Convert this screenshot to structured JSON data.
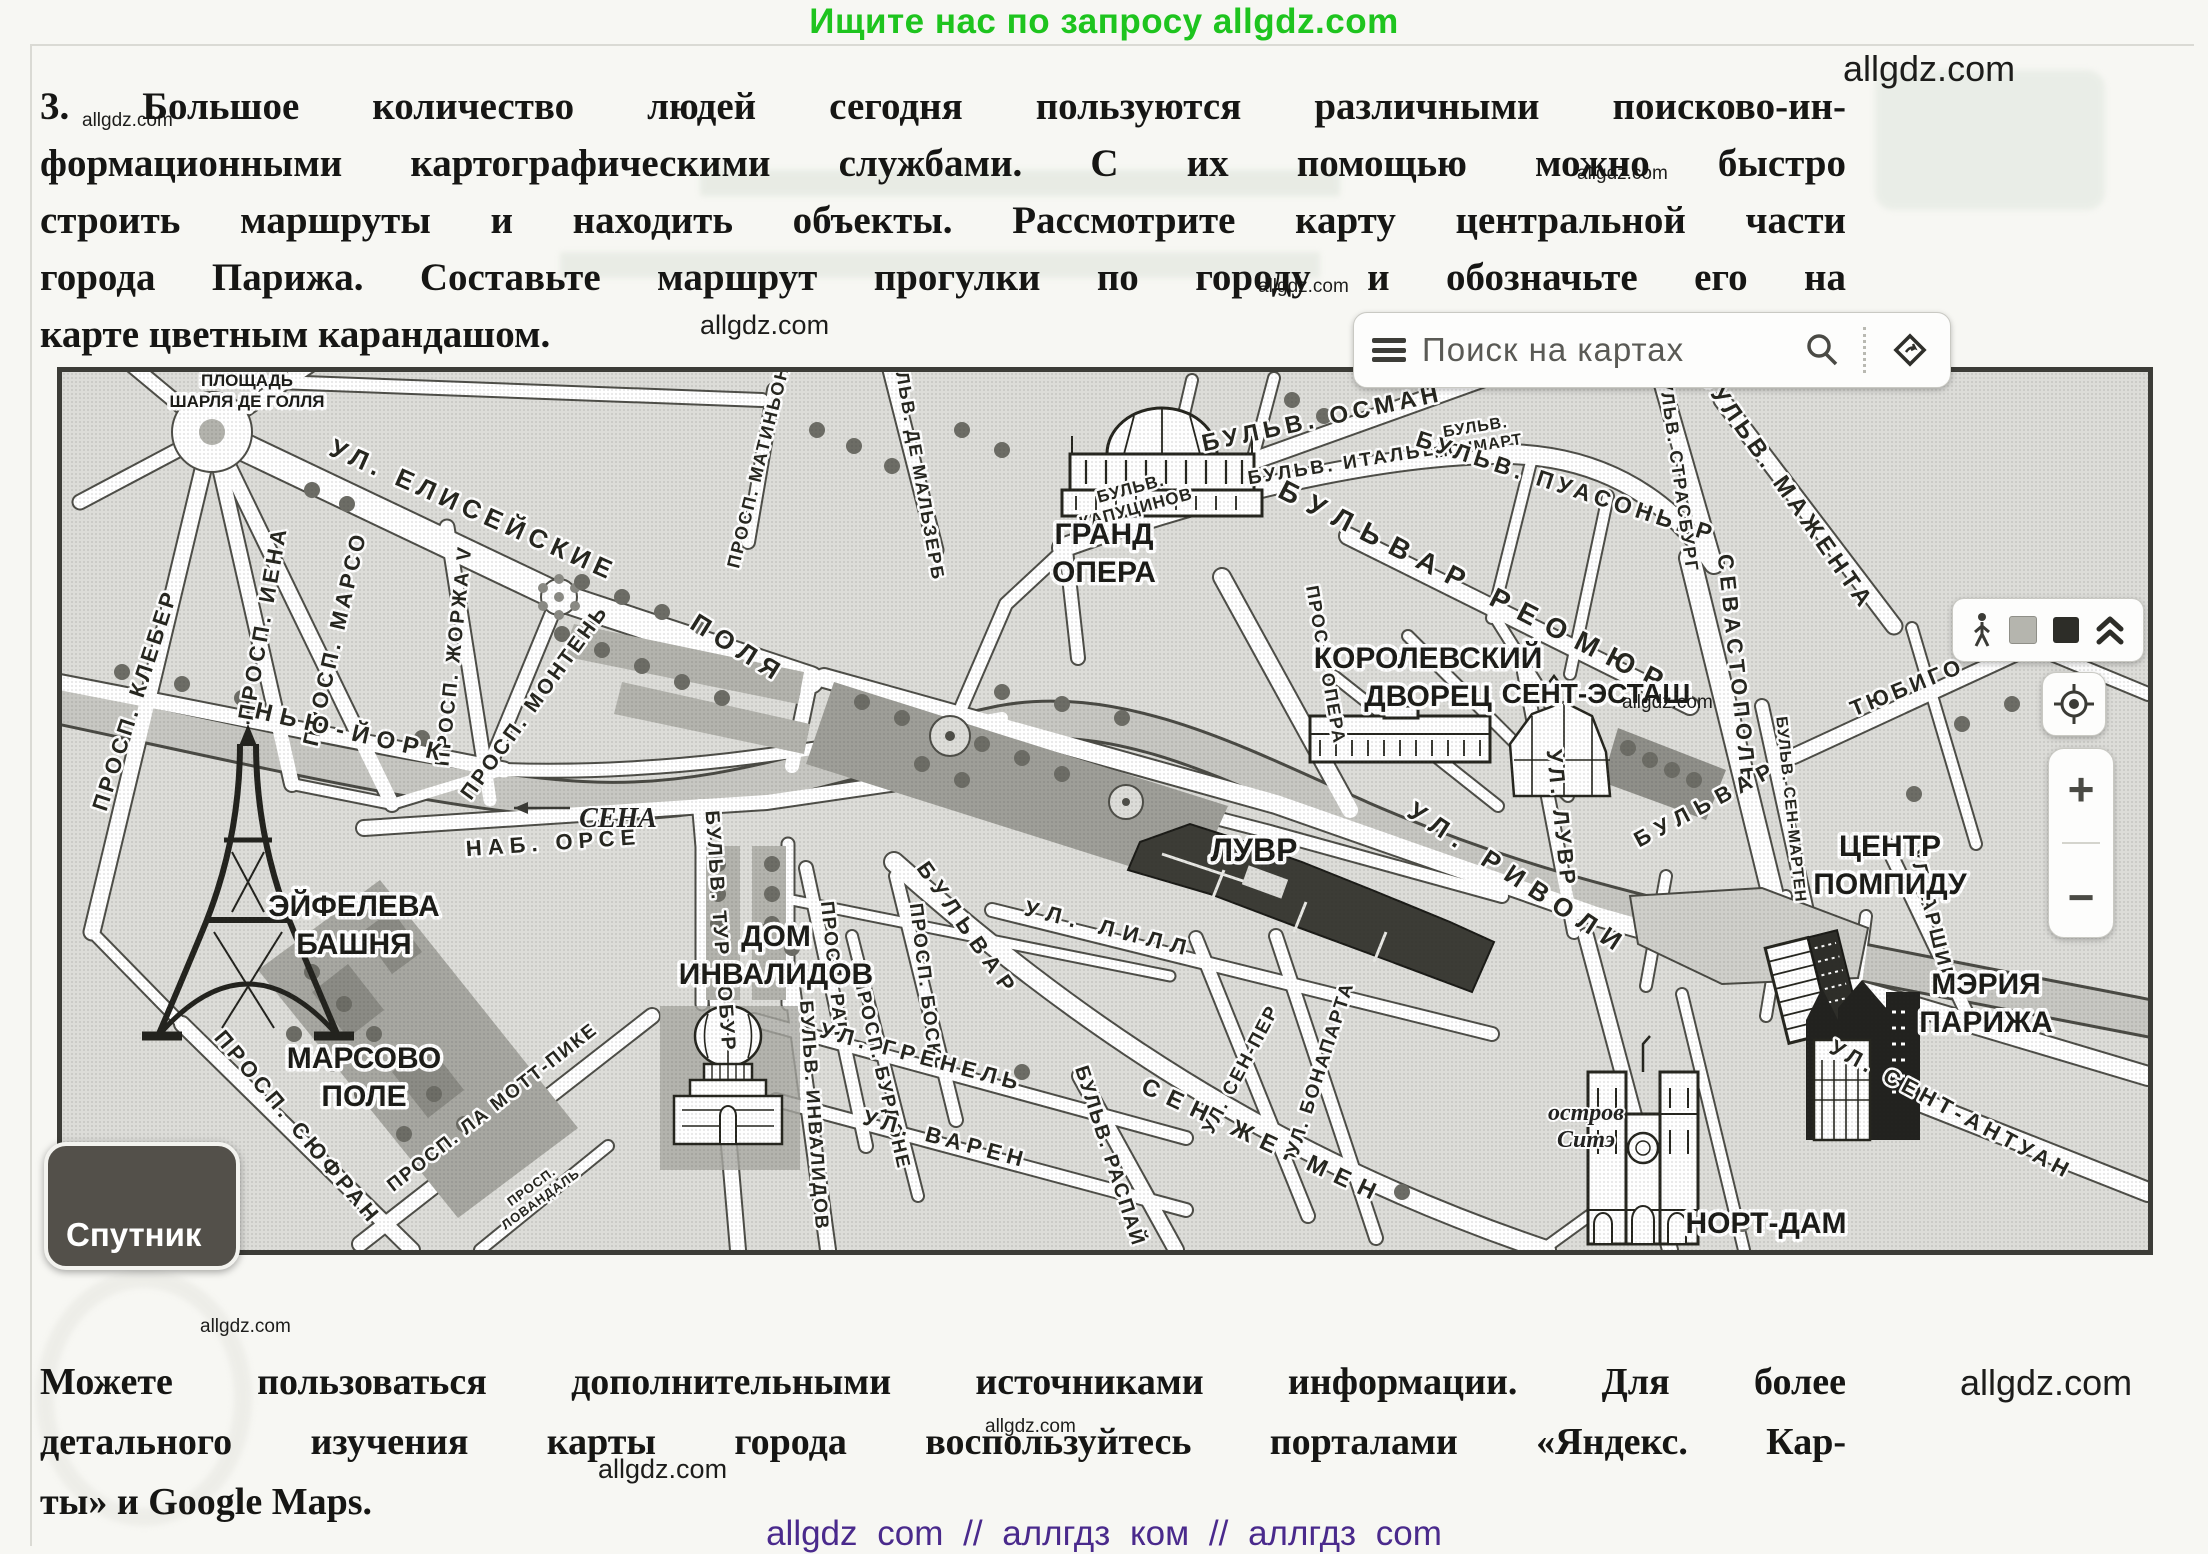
{
  "header": {
    "promo": "Ищите нас по запросу allgdz.com"
  },
  "watermark": {
    "text": "allgdz.com"
  },
  "task": {
    "lines": [
      "3. Большое количество людей сегодня пользуются различными поисково-ин-",
      "формационными картографическими службами. С их помощью можно быстро",
      "строить маршруты и находить объекты. Рассмотрите карту центральной части",
      "города Парижа. Составьте маршрут прогулки по городу и обозначьте его на",
      "карте цветным карандашом."
    ]
  },
  "map": {
    "search": {
      "placeholder": "Поиск на картах"
    },
    "satellite_label": "Спутник",
    "zoom_in_label": "+",
    "zoom_out_label": "−",
    "icons": [
      "hamburger-menu",
      "magnifier",
      "route-diamond",
      "pedestrian",
      "layer-light-square",
      "layer-dark-square",
      "double-chevron-up",
      "compass-target"
    ],
    "watermark": "allgdz.com",
    "landmarks": [
      {
        "lines": [
          "ПЛОЩАДЬ",
          "ШАРЛЯ ДЕ ГОЛЛЯ"
        ],
        "x": 185,
        "y": 14,
        "s": 17,
        "lh": 21
      },
      {
        "lines": [
          "ГРАНД",
          "ОПЕРА"
        ],
        "x": 1042,
        "y": 172,
        "s": 30,
        "lh": 38
      },
      {
        "lines": [
          "КОРОЛЕВСКИЙ",
          "ДВОРЕЦ"
        ],
        "x": 1366,
        "y": 296,
        "s": 30,
        "lh": 38
      },
      {
        "lines": [
          "СЕНТ-ЭСТАШ"
        ],
        "x": 1534,
        "y": 314,
        "s": 28,
        "lh": 34
      },
      {
        "lines": [
          "ЦЕНТР",
          "ПОМПИДУ"
        ],
        "x": 1828,
        "y": 484,
        "s": 30,
        "lh": 38
      },
      {
        "lines": [
          "МЭРИЯ",
          "ПАРИЖА"
        ],
        "x": 1924,
        "y": 622,
        "s": 30,
        "lh": 38
      },
      {
        "lines": [
          "НОРТ-ДАМ"
        ],
        "x": 1704,
        "y": 844,
        "s": 30,
        "lh": 34
      },
      {
        "lines": [
          "ЛУВР"
        ],
        "x": 1192,
        "y": 472,
        "s": 32,
        "lh": 34
      },
      {
        "lines": [
          "ЭЙФЕЛЕВА",
          "БАШНЯ"
        ],
        "x": 292,
        "y": 544,
        "s": 30,
        "lh": 38
      },
      {
        "lines": [
          "ДОМ",
          "ИНВАЛИДОВ"
        ],
        "x": 714,
        "y": 574,
        "s": 30,
        "lh": 38
      },
      {
        "lines": [
          "МАРСОВО",
          "ПОЛЕ"
        ],
        "x": 302,
        "y": 696,
        "s": 30,
        "lh": 38
      },
      {
        "lines": [
          "СЕНА"
        ],
        "x": 556,
        "y": 440,
        "s": 28,
        "lh": 30,
        "cls": "river"
      },
      {
        "lines": [
          "остров",
          "Ситэ"
        ],
        "x": 1524,
        "y": 748,
        "s": 24,
        "lh": 27,
        "cls": "island"
      }
    ],
    "street_labels": [
      {
        "t": "УЛ.  ЕЛИСЕЙСКИЕ",
        "x": 408,
        "y": 146,
        "r": 24,
        "s": 26,
        "ls": 6
      },
      {
        "t": "ПОЛЯ",
        "x": 672,
        "y": 284,
        "r": 32,
        "s": 26,
        "ls": 8
      },
      {
        "t": "ПРОСП.  КЛЕБЕР",
        "x": 80,
        "y": 330,
        "r": -72,
        "s": 22,
        "ls": 4
      },
      {
        "t": "ПРОСП.  ИЕНА",
        "x": 208,
        "y": 252,
        "r": -80,
        "s": 22,
        "ls": 4
      },
      {
        "t": "ПРОСП.  МАРСО",
        "x": 280,
        "y": 268,
        "r": -77,
        "s": 22,
        "ls": 4
      },
      {
        "t": "ПРОСП. ЖОРЖА V",
        "x": 398,
        "y": 284,
        "r": -84,
        "s": 20,
        "ls": 3
      },
      {
        "t": "ПРОСП. МОНТЕНЬ",
        "x": 478,
        "y": 334,
        "r": -54,
        "s": 21,
        "ls": 3
      },
      {
        "t": "ПРОСП. МАТИНЬОН",
        "x": 702,
        "y": 96,
        "r": -76,
        "s": 18,
        "ls": 2
      },
      {
        "t": "БУЛЬВ. ДЕ МАЛЬЗЕРБ",
        "x": 850,
        "y": 92,
        "r": 80,
        "s": 18,
        "ls": 2
      },
      {
        "t": "БУЛЬВ. ОСМАН",
        "x": 1262,
        "y": 54,
        "r": -12,
        "s": 24,
        "ls": 5
      },
      {
        "t": "БУЛЬВ. ИТАЛЬЕН",
        "x": 1290,
        "y": 96,
        "r": -9,
        "s": 19,
        "ls": 3
      },
      {
        "lines": [
          "БУЛЬВ.",
          "МОНМАРТ"
        ],
        "x": 1414,
        "y": 60,
        "r": -9,
        "s": 16,
        "ls": 1
      },
      {
        "t": "БУЛЬВ. ПУАСОНЬЕР",
        "x": 1502,
        "y": 122,
        "r": 18,
        "s": 23,
        "ls": 5
      },
      {
        "t": "БУЛЬВ. СТРАСБУРГ",
        "x": 1610,
        "y": 98,
        "r": 82,
        "s": 18,
        "ls": 2
      },
      {
        "t": "БУЛЬВ. МАЖЕНТА",
        "x": 1718,
        "y": 122,
        "r": 55,
        "s": 24,
        "ls": 5
      },
      {
        "t": "БУЛЬВАР  РЕОМЮР",
        "x": 1410,
        "y": 224,
        "r": 27,
        "s": 28,
        "ls": 12
      },
      {
        "lines": [
          "БУЛЬВ.",
          "КАПУЦИНОВ"
        ],
        "x": 1070,
        "y": 122,
        "r": -15,
        "s": 17,
        "ls": 1
      },
      {
        "t": "ПРОСП. ОПЕРА",
        "x": 1258,
        "y": 294,
        "r": 80,
        "s": 18,
        "ls": 2
      },
      {
        "t": "СЕВАСТОПОЛЬ",
        "x": 1668,
        "y": 300,
        "r": 84,
        "s": 22,
        "ls": 6
      },
      {
        "t": "БУЛЬВАР",
        "x": 1648,
        "y": 438,
        "r": -28,
        "s": 22,
        "ls": 8
      },
      {
        "t": "БУЛЬВ. СЕН-МАРТЕН",
        "x": 1724,
        "y": 438,
        "r": 84,
        "s": 16,
        "ls": 1
      },
      {
        "t": "ТЮБИГО",
        "x": 1848,
        "y": 322,
        "r": -22,
        "s": 22,
        "ls": 4
      },
      {
        "t": "УЛ. ЛУВР",
        "x": 1492,
        "y": 448,
        "r": 84,
        "s": 22,
        "ls": 5
      },
      {
        "t": "УЛ.  РИВОЛИ",
        "x": 1452,
        "y": 514,
        "r": 33,
        "s": 26,
        "ls": 10
      },
      {
        "t": "УЛ. АРШИВ",
        "x": 1864,
        "y": 546,
        "r": 76,
        "s": 20,
        "ls": 3
      },
      {
        "t": "УЛ. СЕНТ-АНТУАН",
        "x": 1886,
        "y": 744,
        "r": 28,
        "s": 22,
        "ls": 5
      },
      {
        "t": "НЬЮ-ЙОРК",
        "x": 288,
        "y": 368,
        "r": 13,
        "s": 24,
        "ls": 8
      },
      {
        "t": "НАБ.  ОРСЕ",
        "x": 492,
        "y": 478,
        "r": -4,
        "s": 22,
        "ls": 6
      },
      {
        "t": "БУЛЬВ. ТУР МОБУР",
        "x": 652,
        "y": 560,
        "r": 86,
        "s": 20,
        "ls": 3
      },
      {
        "t": "ПРОСП. РАП",
        "x": 766,
        "y": 598,
        "r": 84,
        "s": 19,
        "ls": 2
      },
      {
        "t": "ПРОСП. БОСКЕ",
        "x": 858,
        "y": 616,
        "r": 83,
        "s": 19,
        "ls": 2
      },
      {
        "t": "ПРОСП. БУРДОНЕ",
        "x": 814,
        "y": 702,
        "r": 77,
        "s": 19,
        "ls": 2
      },
      {
        "t": "ПРОСП. СЮФРАН",
        "x": 230,
        "y": 760,
        "r": 50,
        "s": 22,
        "ls": 4
      },
      {
        "t": "ПРОСП. ЛА МОТТ-ПИКЕ",
        "x": 434,
        "y": 740,
        "r": -38,
        "s": 19,
        "ls": 2
      },
      {
        "lines": [
          "ПРОСП.",
          "ЛОВАНДАЛЬ"
        ],
        "x": 472,
        "y": 818,
        "r": -36,
        "s": 13,
        "ls": 1
      },
      {
        "t": "БУЛЬВ. ИНВАЛИДОВ",
        "x": 746,
        "y": 744,
        "r": 86,
        "s": 19,
        "ls": 2
      },
      {
        "t": "УЛ.  ГРЕНЕЛЬ",
        "x": 858,
        "y": 692,
        "r": 15,
        "s": 22,
        "ls": 6
      },
      {
        "t": "УЛ.  ВАРЕН",
        "x": 882,
        "y": 774,
        "r": 15,
        "s": 22,
        "ls": 6
      },
      {
        "t": "УЛ.  ЛИЛЛ",
        "x": 1046,
        "y": 564,
        "r": 14,
        "s": 22,
        "ls": 9
      },
      {
        "t": "БУЛЬВАР",
        "x": 900,
        "y": 562,
        "r": 55,
        "s": 22,
        "ls": 8
      },
      {
        "t": "СЕН-ЖЕРМЕН",
        "x": 1198,
        "y": 776,
        "r": 25,
        "s": 24,
        "ls": 10
      },
      {
        "t": "УЛ. СЕН-ПЕР",
        "x": 1184,
        "y": 700,
        "r": -62,
        "s": 19,
        "ls": 2
      },
      {
        "t": "УЛ. БОНАПАРТА",
        "x": 1264,
        "y": 698,
        "r": -72,
        "s": 19,
        "ls": 2
      },
      {
        "t": "БУЛЬВ. РАСПАЙ",
        "x": 1042,
        "y": 786,
        "r": 72,
        "s": 20,
        "ls": 2
      }
    ]
  },
  "bottom": {
    "lines": [
      "Можете пользоваться дополнительными источниками информации. Для более",
      "детального изучения карты города воспользуйтесь порталами «Яндекс. Кар-",
      "ты» и Google Maps."
    ]
  },
  "footer": {
    "text": "allgdz com // аллгдз ком // аллгдз com"
  }
}
